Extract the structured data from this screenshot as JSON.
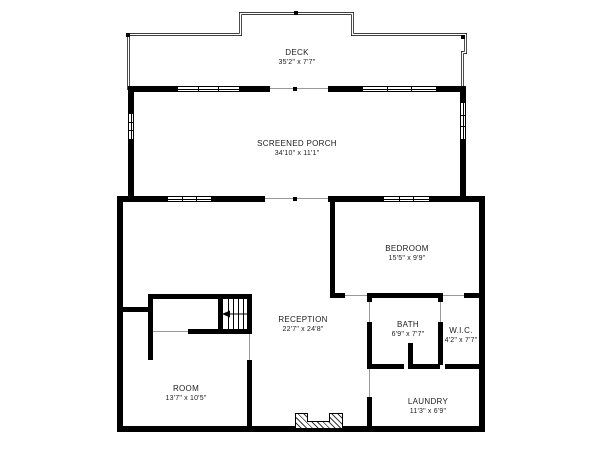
{
  "plan": {
    "background": "#ffffff",
    "wall_color": "#000000",
    "rooms": {
      "deck": {
        "name": "DECK",
        "dims": "35'2\" x 7'7\""
      },
      "screened_porch": {
        "name": "SCREENED PORCH",
        "dims": "34'10\" x 11'1\""
      },
      "bedroom": {
        "name": "BEDROOM",
        "dims": "15'5\" x 9'9\""
      },
      "reception": {
        "name": "RECEPTION",
        "dims": "22'7\" x 24'8\""
      },
      "bath": {
        "name": "BATH",
        "dims": "6'9\" x 7'7\""
      },
      "wic": {
        "name": "W.I.C.",
        "dims": "4'2\" x 7'7\""
      },
      "room": {
        "name": "ROOM",
        "dims": "13'7\" x 10'5\""
      },
      "laundry": {
        "name": "LAUNDRY",
        "dims": "11'3\" x 6'9\""
      }
    }
  }
}
